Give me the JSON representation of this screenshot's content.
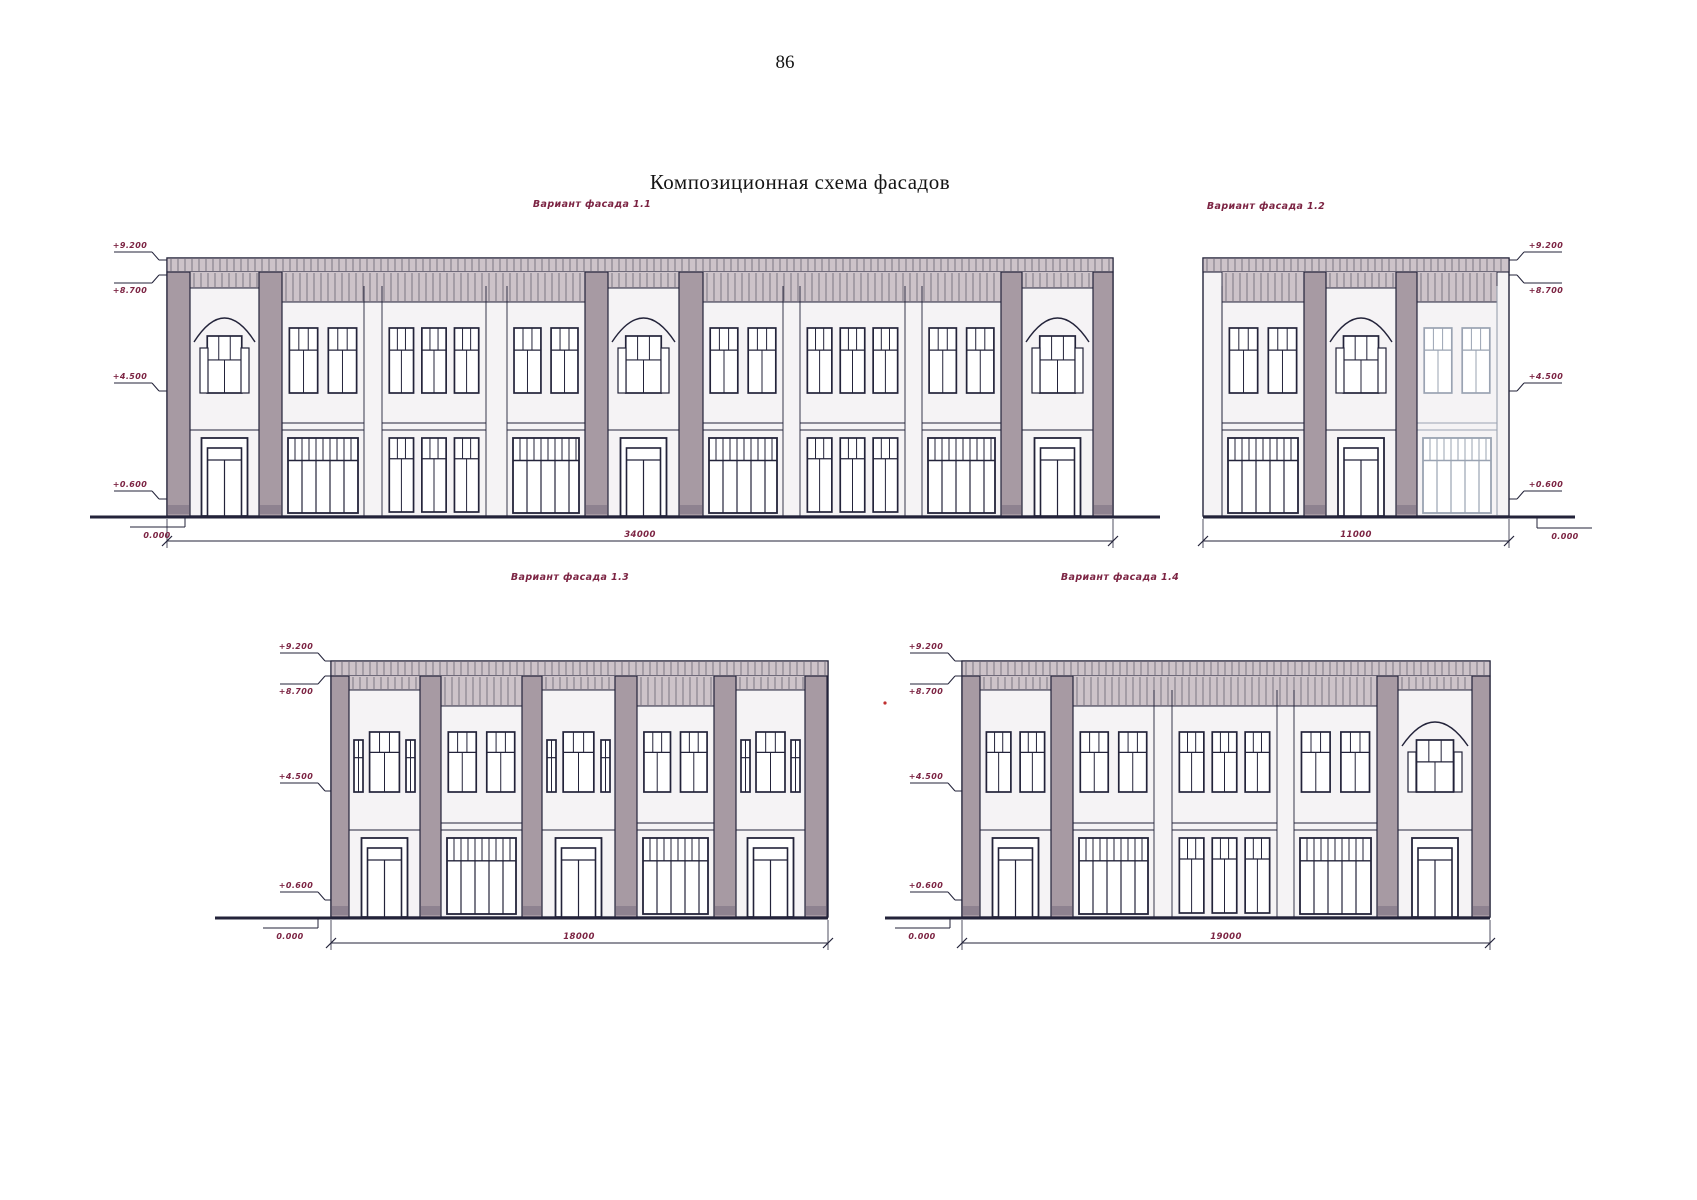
{
  "page": {
    "number": "86",
    "title": "Композиционная схема фасадов"
  },
  "colors": {
    "line": "#23233a",
    "wall": "#f5f3f5",
    "band": "#cdc3c9",
    "hatch": "#5a5663",
    "pilaster": "#a79aa3",
    "pilaster_base": "#8e8290",
    "annotation": "#7c2443",
    "faded_line": "#9aa3b2",
    "faded_hatch": "#c2c6ce",
    "faded_band": "#dfdae0",
    "artifact_red": "#c03030"
  },
  "metrics": {
    "top": {
      "t": 258,
      "b": 272,
      "wt": 328,
      "wb": 393,
      "sb": 430,
      "st": 438,
      "g": 516
    },
    "bot": {
      "t": 661,
      "b": 676,
      "wt": 732,
      "wb": 792,
      "sb": 830,
      "st": 838,
      "g": 917
    }
  },
  "facades": [
    {
      "id": "1-1",
      "label": "Вариант фасада  1.1",
      "label_cx": 592,
      "label_y": 207,
      "metrics": "top",
      "x0": 167,
      "x1": 1113,
      "ground_ext": [
        90,
        1160
      ],
      "dim": {
        "text": "34000",
        "y": 541,
        "tx": 640
      },
      "marks": {
        "side": "left",
        "ax": 152,
        "items": [
          {
            "text": "+9.200",
            "ly": 260,
            "tp": "above"
          },
          {
            "text": "+8.700",
            "ly": 275,
            "tp": "below"
          },
          {
            "text": "+4.500",
            "ly": 391,
            "tp": "above"
          },
          {
            "text": "+0.600",
            "ly": 499,
            "tp": "above"
          },
          {
            "text": "0.000",
            "ly": 516,
            "tp": "zero",
            "jog": 185
          }
        ]
      },
      "pilasters": [
        [
          167,
          190
        ],
        [
          259,
          282
        ],
        [
          585,
          608
        ],
        [
          679,
          703
        ],
        [
          1001,
          1022
        ],
        [
          1093,
          1113
        ]
      ],
      "zones": [
        [
          190,
          259,
          16
        ],
        [
          282,
          585,
          30
        ],
        [
          608,
          679,
          16
        ],
        [
          703,
          1001,
          30
        ],
        [
          1022,
          1093,
          16
        ]
      ],
      "bays": [
        [
          190,
          259,
          "arch_door"
        ],
        [
          282,
          364,
          "w2_store"
        ],
        [
          382,
          486,
          "w3_w3"
        ],
        [
          507,
          585,
          "w2_store"
        ],
        [
          608,
          679,
          "arch_door"
        ],
        [
          703,
          783,
          "w2_store"
        ],
        [
          800,
          905,
          "w3_w3"
        ],
        [
          922,
          1001,
          "w2_store"
        ],
        [
          1022,
          1093,
          "arch_door"
        ]
      ]
    },
    {
      "id": "1-2",
      "label": "Вариант фасада  1.2",
      "label_cx": 1266,
      "label_y": 209,
      "metrics": "top",
      "x0": 1203,
      "x1": 1509,
      "ground_ext": [
        1203,
        1575
      ],
      "dim": {
        "text": "11000",
        "y": 541,
        "tx": 1356
      },
      "marks": {
        "side": "right",
        "ax": 1524,
        "items": [
          {
            "text": "+9.200",
            "ly": 260,
            "tp": "above"
          },
          {
            "text": "+8.700",
            "ly": 275,
            "tp": "below"
          },
          {
            "text": "+4.500",
            "ly": 391,
            "tp": "above"
          },
          {
            "text": "+0.600",
            "ly": 499,
            "tp": "above"
          },
          {
            "text": "0.000",
            "ly": 517,
            "tp": "zero",
            "jog": 1537
          }
        ]
      },
      "pilasters": [
        [
          1304,
          1326
        ],
        [
          1396,
          1417
        ]
      ],
      "zones": [
        [
          1222,
          1304,
          30
        ],
        [
          1326,
          1396,
          16
        ],
        [
          1417,
          1497,
          30
        ]
      ],
      "bays": [
        [
          1222,
          1304,
          "w2_store"
        ],
        [
          1326,
          1396,
          "arch_door"
        ],
        [
          1417,
          1497,
          "w2_store",
          "faded"
        ]
      ]
    },
    {
      "id": "1-3",
      "label": "Вариант фасада  1.3",
      "label_cx": 570,
      "label_y": 580,
      "metrics": "bot",
      "x0": 331,
      "x1": 828,
      "ground_ext": [
        215,
        828
      ],
      "dim": {
        "text": "18000",
        "y": 943,
        "tx": 579
      },
      "marks": {
        "side": "left",
        "ax": 318,
        "items": [
          {
            "text": "+9.200",
            "ly": 661,
            "tp": "above"
          },
          {
            "text": "+8.700",
            "ly": 676,
            "tp": "below"
          },
          {
            "text": "+4.500",
            "ly": 791,
            "tp": "above"
          },
          {
            "text": "+0.600",
            "ly": 900,
            "tp": "above"
          },
          {
            "text": "0.000",
            "ly": 917,
            "tp": "zero",
            "jog": 318
          }
        ]
      },
      "pilasters": [
        [
          331,
          349
        ],
        [
          420,
          441
        ],
        [
          522,
          542
        ],
        [
          615,
          637
        ],
        [
          714,
          736
        ],
        [
          805,
          827
        ]
      ],
      "zones": [
        [
          349,
          420,
          14
        ],
        [
          441,
          522,
          30
        ],
        [
          542,
          615,
          14
        ],
        [
          637,
          714,
          30
        ],
        [
          736,
          805,
          14
        ]
      ],
      "bays": [
        [
          349,
          420,
          "nwn_door"
        ],
        [
          441,
          522,
          "w2_store"
        ],
        [
          542,
          615,
          "nwn_door"
        ],
        [
          637,
          714,
          "w2_store"
        ],
        [
          736,
          805,
          "nwn_door"
        ]
      ]
    },
    {
      "id": "1-4",
      "label": "Вариант фасада  1.4",
      "label_cx": 1120,
      "label_y": 580,
      "metrics": "bot",
      "x0": 962,
      "x1": 1490,
      "ground_ext": [
        885,
        1490
      ],
      "dim": {
        "text": "19000",
        "y": 943,
        "tx": 1226
      },
      "marks": {
        "side": "left",
        "ax": 948,
        "items": [
          {
            "text": "+9.200",
            "ly": 661,
            "tp": "above"
          },
          {
            "text": "+8.700",
            "ly": 676,
            "tp": "below"
          },
          {
            "text": "+4.500",
            "ly": 791,
            "tp": "above"
          },
          {
            "text": "+0.600",
            "ly": 900,
            "tp": "above"
          },
          {
            "text": "0.000",
            "ly": 917,
            "tp": "zero",
            "jog": 950
          }
        ]
      },
      "pilasters": [
        [
          962,
          980
        ],
        [
          1051,
          1073
        ],
        [
          1377,
          1398
        ],
        [
          1472,
          1490
        ]
      ],
      "zones": [
        [
          980,
          1051,
          14
        ],
        [
          1073,
          1377,
          30
        ],
        [
          1398,
          1472,
          14
        ]
      ],
      "bays": [
        [
          980,
          1051,
          "w2_door"
        ],
        [
          1073,
          1154,
          "w2_store"
        ],
        [
          1172,
          1277,
          "w3_w3"
        ],
        [
          1294,
          1377,
          "w2_store"
        ],
        [
          1398,
          1472,
          "arch_door"
        ]
      ],
      "artifact_dot": [
        885,
        703
      ]
    }
  ]
}
